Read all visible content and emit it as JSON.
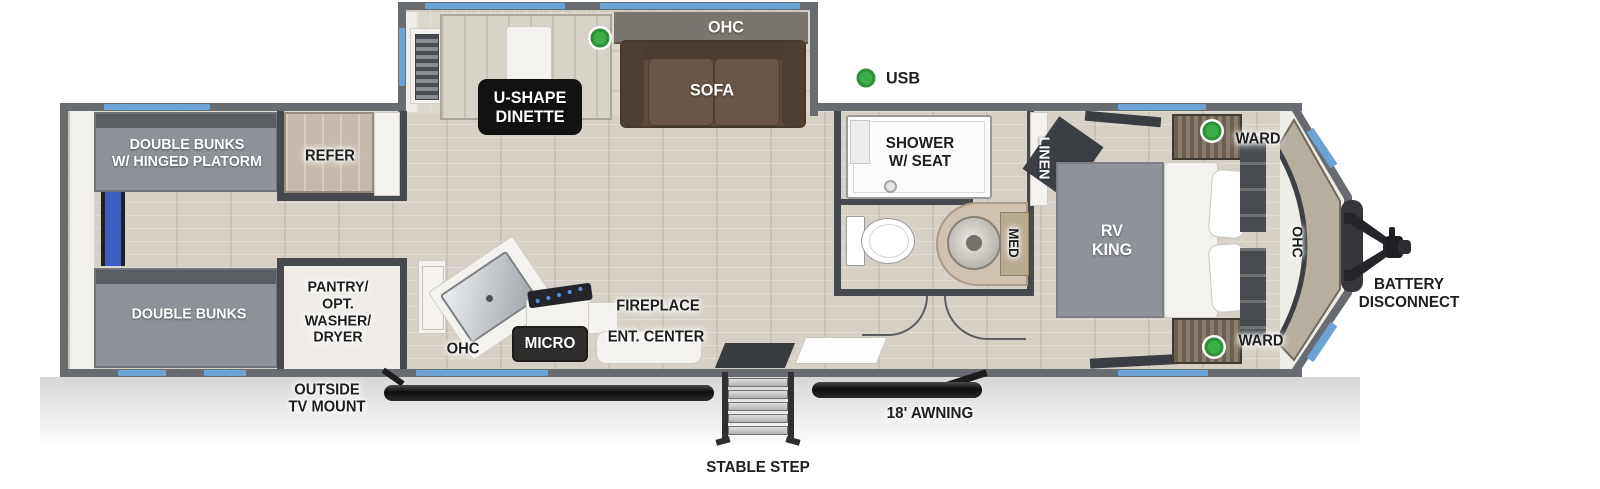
{
  "fp": {
    "slide": {
      "ohc": "OHC",
      "sofa": "SOFA",
      "dinette": [
        "U-SHAPE",
        "DINETTE"
      ]
    },
    "rear": {
      "bunk_top": [
        "DOUBLE BUNKS",
        "W/ HINGED PLATORM"
      ],
      "bunk_bottom": "DOUBLE BUNKS",
      "refer": "REFER",
      "pantry": [
        "PANTRY/",
        "OPT.",
        "WASHER/",
        "DRYER"
      ]
    },
    "kitchen": {
      "ohc": "OHC",
      "micro": "MICRO",
      "fireplace": "FIREPLACE",
      "ent_center": "ENT. CENTER"
    },
    "bath": {
      "shower": [
        "SHOWER",
        "W/ SEAT"
      ],
      "med": "MED",
      "linen": "LINEN"
    },
    "bedroom": {
      "bed": [
        "RV",
        "KING"
      ],
      "ward_top": "WARD",
      "ward_bottom": "WARD",
      "ohc": "OHC"
    },
    "exterior": {
      "usb": "USB",
      "outside_tv": [
        "OUTSIDE",
        "TV MOUNT"
      ],
      "stable_step": "STABLE STEP",
      "awning": "18' AWNING",
      "battery": [
        "BATTERY",
        "DISCONNECT"
      ]
    },
    "colors": {
      "wall": "#686c70",
      "window_blue": "#6ba3d6",
      "indicator_green": "#3dae47",
      "floor": "#d6d0c6",
      "sofa_brown": "#5d4a3b",
      "refer_tan": "#c6bbaa"
    }
  }
}
